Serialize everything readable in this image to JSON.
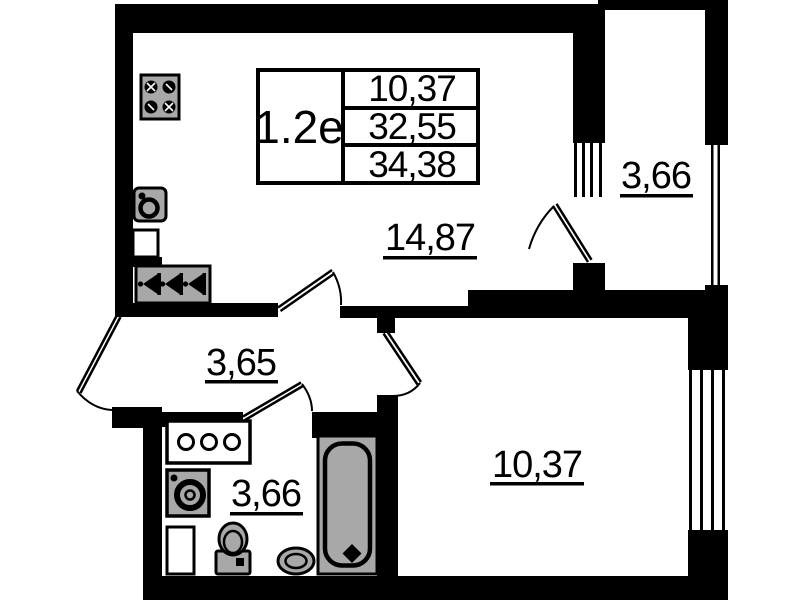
{
  "unit_card": {
    "unit_label": "1.2е",
    "values": [
      "10,37",
      "32,55",
      "34,38"
    ]
  },
  "rooms": [
    {
      "id": "kitchen-living-room",
      "area": "14,87"
    },
    {
      "id": "balcony",
      "area": "3,66"
    },
    {
      "id": "hallway",
      "area": "3,65"
    },
    {
      "id": "bathroom",
      "area": "3,66"
    },
    {
      "id": "bedroom",
      "area": "10,37"
    }
  ],
  "fixtures": [
    "stove-icon",
    "kitchen-sink-icon",
    "wall-niche",
    "meter-box-icon",
    "counter-icon",
    "washing-machine-icon",
    "cabinet-icon",
    "toilet-icon",
    "basin-icon",
    "bathtub-icon"
  ],
  "colors": {
    "wall": "#000000",
    "fixture_fill": "#a8a8a8",
    "background": "#ffffff"
  }
}
